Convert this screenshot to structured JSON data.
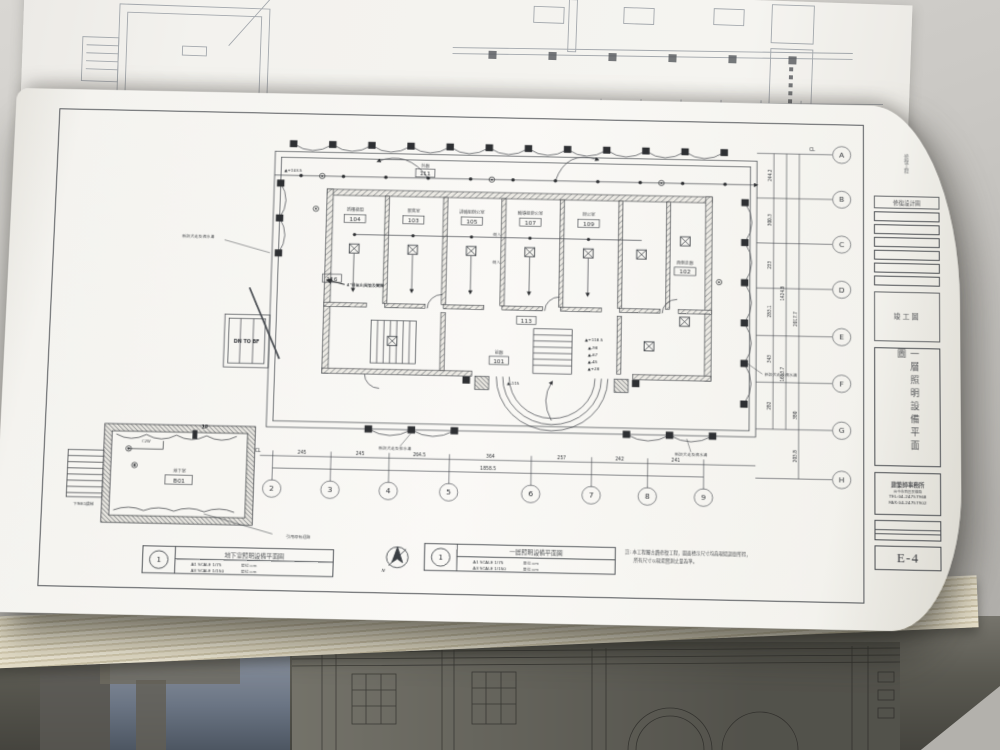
{
  "sheet": {
    "number": "E-4",
    "stamp": "竣工圖",
    "design_label": "修復設計圖",
    "head_vertical": "修復工程",
    "title_vertical": "一層照明設備平面圖",
    "firm_name": "建築師事務所",
    "firm_addr": "台中市西區民權路",
    "firm_tel": "TEL:04-24757968",
    "firm_fax": "FAX:04-24757902"
  },
  "legends": [
    {
      "num": "1",
      "title": "地下室照明設備平面圖",
      "s1": "A1 SCALE 1/75",
      "s2": "A3 SCALE 1/150",
      "unit": "單位:cm"
    },
    {
      "num": "1",
      "title": "一層照明設備平面圖",
      "s1": "A1 SCALE 1/75",
      "s2": "A3 SCALE 1/150",
      "unit": "單位:cm"
    }
  ],
  "note": {
    "l1": "註: 本工程屬古蹟修復工程，圖面標示尺寸均為現場調查所得，",
    "l2": "所有尺寸以現場實測丈量為準。"
  },
  "plan": {
    "rooms": [
      {
        "id": "104",
        "name": "新樓梯間"
      },
      {
        "id": "103",
        "name": "展售室"
      },
      {
        "id": "105",
        "name": "訓輔組辦公室"
      },
      {
        "id": "107",
        "name": "輔導組辦公室"
      },
      {
        "id": "109",
        "name": "辦公室"
      },
      {
        "id": "102",
        "name": "西側走廊"
      },
      {
        "id": "116",
        "name": "機房"
      },
      {
        "id": "111",
        "name": "外廊"
      },
      {
        "id": "113",
        "name": "川堂"
      },
      {
        "id": "101",
        "name": "前廊"
      },
      {
        "id": "B01",
        "name": "地下室"
      }
    ],
    "grid_cols": [
      "2",
      "3",
      "4",
      "5",
      "6",
      "7",
      "8",
      "9"
    ],
    "col_dims": [
      "245",
      "245",
      "264.5",
      "364",
      "257",
      "242",
      "241"
    ],
    "col_total": "1858.5",
    "cl": "CL",
    "grid_rows": [
      "A",
      "B",
      "C",
      "D",
      "E",
      "F",
      "G",
      "H"
    ],
    "row_dims": [
      "244.2",
      "300.3",
      "233",
      "283.1",
      "343",
      "282",
      "203.8",
      "380"
    ],
    "row_totals": [
      "1424.8",
      "1653.7",
      "2017.7"
    ],
    "levels": [
      "▲+118.5",
      "▲-98",
      "▲-67",
      "▲-45",
      "▲+28"
    ],
    "level_low": "▲-115",
    "level_high": "▲+103.5",
    "dn_to_bf": "DN TO BF",
    "vent_note": "4\"排氣出風管及閘閥",
    "side_in": "側入",
    "ann_perimeter": "新設犬走及洩水溝",
    "ann_drain": "新設犬走及排水溝",
    "north": "N"
  },
  "basement": {
    "name": "地下室",
    "id": "B01",
    "panel": "1P",
    "fixture": "C2W",
    "stair_note": "下至B1樓梯",
    "leader_note": "引用原有迴路"
  }
}
